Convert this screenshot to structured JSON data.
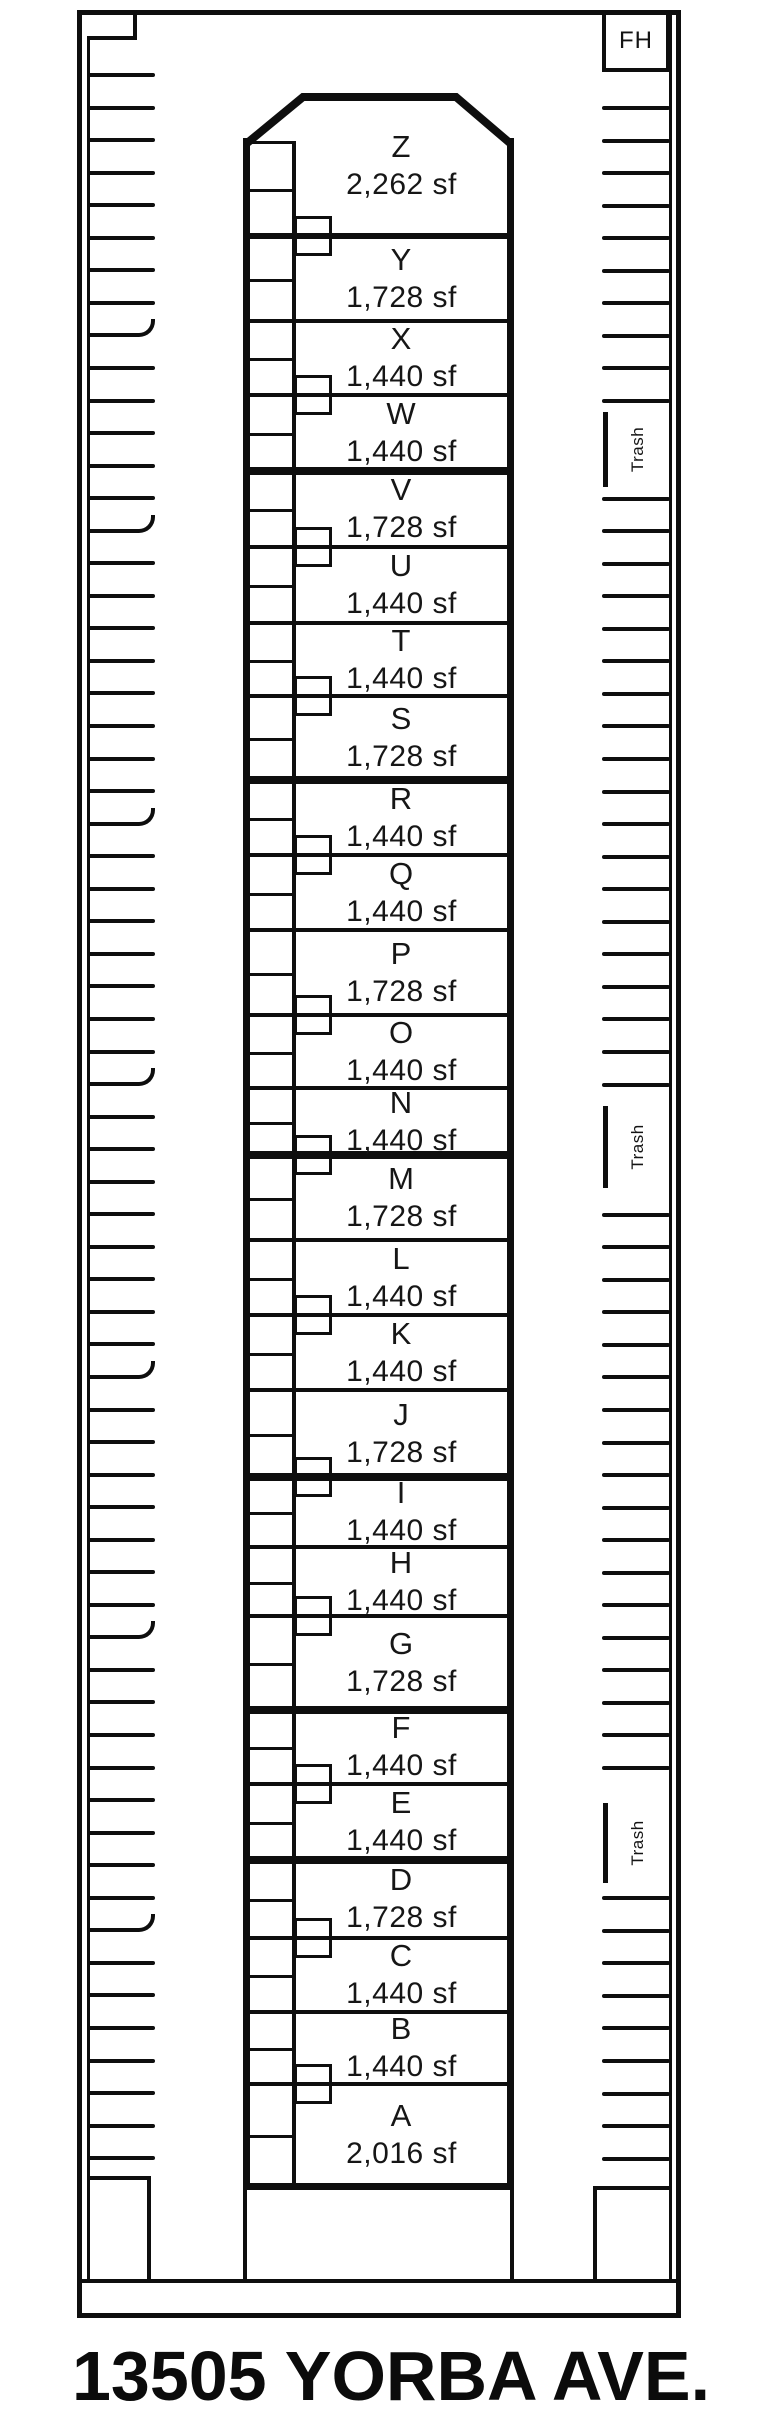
{
  "title": "13505 YORBA AVE.",
  "fh_label": "FH",
  "trash_label": "Trash",
  "colors": {
    "ink": "#0e0e0e",
    "background": "#ffffff"
  },
  "units": [
    {
      "letter": "Z",
      "area": "2,262 sf",
      "top": 96,
      "bottom": 236,
      "divider": "medium",
      "notch": true
    },
    {
      "letter": "Y",
      "area": "1,728 sf",
      "top": 236,
      "bottom": 321,
      "divider": "thin",
      "notch": false
    },
    {
      "letter": "X",
      "area": "1,440 sf",
      "top": 321,
      "bottom": 395,
      "divider": "thin",
      "notch": true
    },
    {
      "letter": "W",
      "area": "1,440 sf",
      "top": 395,
      "bottom": 471,
      "divider": "thick",
      "notch": false
    },
    {
      "letter": "V",
      "area": "1,728 sf",
      "top": 471,
      "bottom": 547,
      "divider": "thin",
      "notch": true
    },
    {
      "letter": "U",
      "area": "1,440 sf",
      "top": 547,
      "bottom": 623,
      "divider": "thin",
      "notch": false
    },
    {
      "letter": "T",
      "area": "1,440 sf",
      "top": 623,
      "bottom": 696,
      "divider": "thin",
      "notch": true
    },
    {
      "letter": "S",
      "area": "1,728 sf",
      "top": 696,
      "bottom": 780,
      "divider": "thick",
      "notch": false
    },
    {
      "letter": "R",
      "area": "1,440 sf",
      "top": 780,
      "bottom": 855,
      "divider": "thin",
      "notch": true
    },
    {
      "letter": "Q",
      "area": "1,440 sf",
      "top": 855,
      "bottom": 930,
      "divider": "thin",
      "notch": false
    },
    {
      "letter": "P",
      "area": "1,728 sf",
      "top": 930,
      "bottom": 1015,
      "divider": "thin",
      "notch": true
    },
    {
      "letter": "O",
      "area": "1,440 sf",
      "top": 1015,
      "bottom": 1088,
      "divider": "thin",
      "notch": false
    },
    {
      "letter": "N",
      "area": "1,440 sf",
      "top": 1088,
      "bottom": 1155,
      "divider": "thick",
      "notch": true
    },
    {
      "letter": "M",
      "area": "1,728 sf",
      "top": 1155,
      "bottom": 1240,
      "divider": "thin",
      "notch": false
    },
    {
      "letter": "L",
      "area": "1,440 sf",
      "top": 1240,
      "bottom": 1315,
      "divider": "thin",
      "notch": true
    },
    {
      "letter": "K",
      "area": "1,440 sf",
      "top": 1315,
      "bottom": 1390,
      "divider": "thin",
      "notch": false
    },
    {
      "letter": "J",
      "area": "1,728 sf",
      "top": 1390,
      "bottom": 1477,
      "divider": "thick",
      "notch": true
    },
    {
      "letter": "I",
      "area": "1,440 sf",
      "top": 1477,
      "bottom": 1547,
      "divider": "thin",
      "notch": false
    },
    {
      "letter": "H",
      "area": "1,440 sf",
      "top": 1547,
      "bottom": 1616,
      "divider": "thin",
      "notch": true
    },
    {
      "letter": "G",
      "area": "1,728 sf",
      "top": 1616,
      "bottom": 1710,
      "divider": "thick",
      "notch": false
    },
    {
      "letter": "F",
      "area": "1,440 sf",
      "top": 1710,
      "bottom": 1784,
      "divider": "thin",
      "notch": true
    },
    {
      "letter": "E",
      "area": "1,440 sf",
      "top": 1784,
      "bottom": 1860,
      "divider": "thick",
      "notch": false
    },
    {
      "letter": "D",
      "area": "1,728 sf",
      "top": 1860,
      "bottom": 1938,
      "divider": "thin",
      "notch": true
    },
    {
      "letter": "C",
      "area": "1,440 sf",
      "top": 1938,
      "bottom": 2012,
      "divider": "thin",
      "notch": false
    },
    {
      "letter": "B",
      "area": "1,440 sf",
      "top": 2012,
      "bottom": 2084,
      "divider": "thin",
      "notch": true
    },
    {
      "letter": "A",
      "area": "2,016 sf",
      "top": 2084,
      "bottom": 2185,
      "divider": "none",
      "notch": false
    }
  ],
  "plan": {
    "site": {
      "x": 77,
      "y": 10,
      "w": 604,
      "h": 2308,
      "border": 5
    },
    "inner_left_x": 87,
    "inner_right_x": 669,
    "inner_line_w": 3,
    "band_y": 2279,
    "top_left_notch": {
      "vx": 133,
      "v_y0": 13,
      "v_y1": 40,
      "hy": 36,
      "h_x0": 89,
      "h_x1": 137
    },
    "bottom_left_rect": {
      "x": 89,
      "y": 2176,
      "w": 62,
      "h": 105
    },
    "bottom_right_rect": {
      "x": 593,
      "y": 2186,
      "w": 78,
      "h": 95
    },
    "fh_box": {
      "x": 602,
      "y": 10,
      "w": 68,
      "h": 62
    },
    "building": {
      "left_x": 243,
      "right_x": 507,
      "wall_w": 7,
      "wall_top": 138,
      "bottom_line_y": 2183,
      "cap": {
        "x": 240,
        "y": 90,
        "points": "6,54 63,7 216,7 271,54"
      },
      "stub_bottom": 2281
    },
    "closet": {
      "line_x": 292,
      "line_w": 4,
      "cell_x0": 246,
      "cell_x1": 296,
      "top_y": 141
    },
    "divider_px": {
      "thin": 4,
      "medium": 6,
      "thick": 8
    },
    "divider_x0": 246,
    "divider_x1": 510,
    "notch": {
      "x": 294,
      "w": 38,
      "h": 40,
      "border": 3
    },
    "label_box": {
      "x": 296,
      "w": 211
    },
    "parking": {
      "left": {
        "x": 87,
        "len": 68,
        "y0": 73,
        "spacing": 32.55,
        "count": 65,
        "curved": [
          8,
          14,
          23,
          31,
          40,
          48,
          57
        ]
      },
      "right": {
        "x": 602,
        "len": 68,
        "y0": 106,
        "spacing": 32.55,
        "count": 64,
        "skip": [
          10,
          11,
          31,
          32,
          33,
          52,
          53,
          54
        ]
      },
      "tick_h": 4,
      "trash_zones": [
        {
          "y": 412,
          "h": 75
        },
        {
          "y": 1106,
          "h": 82
        },
        {
          "y": 1803,
          "h": 80
        }
      ],
      "trash_bar": {
        "x": 603,
        "w": 5
      }
    }
  }
}
